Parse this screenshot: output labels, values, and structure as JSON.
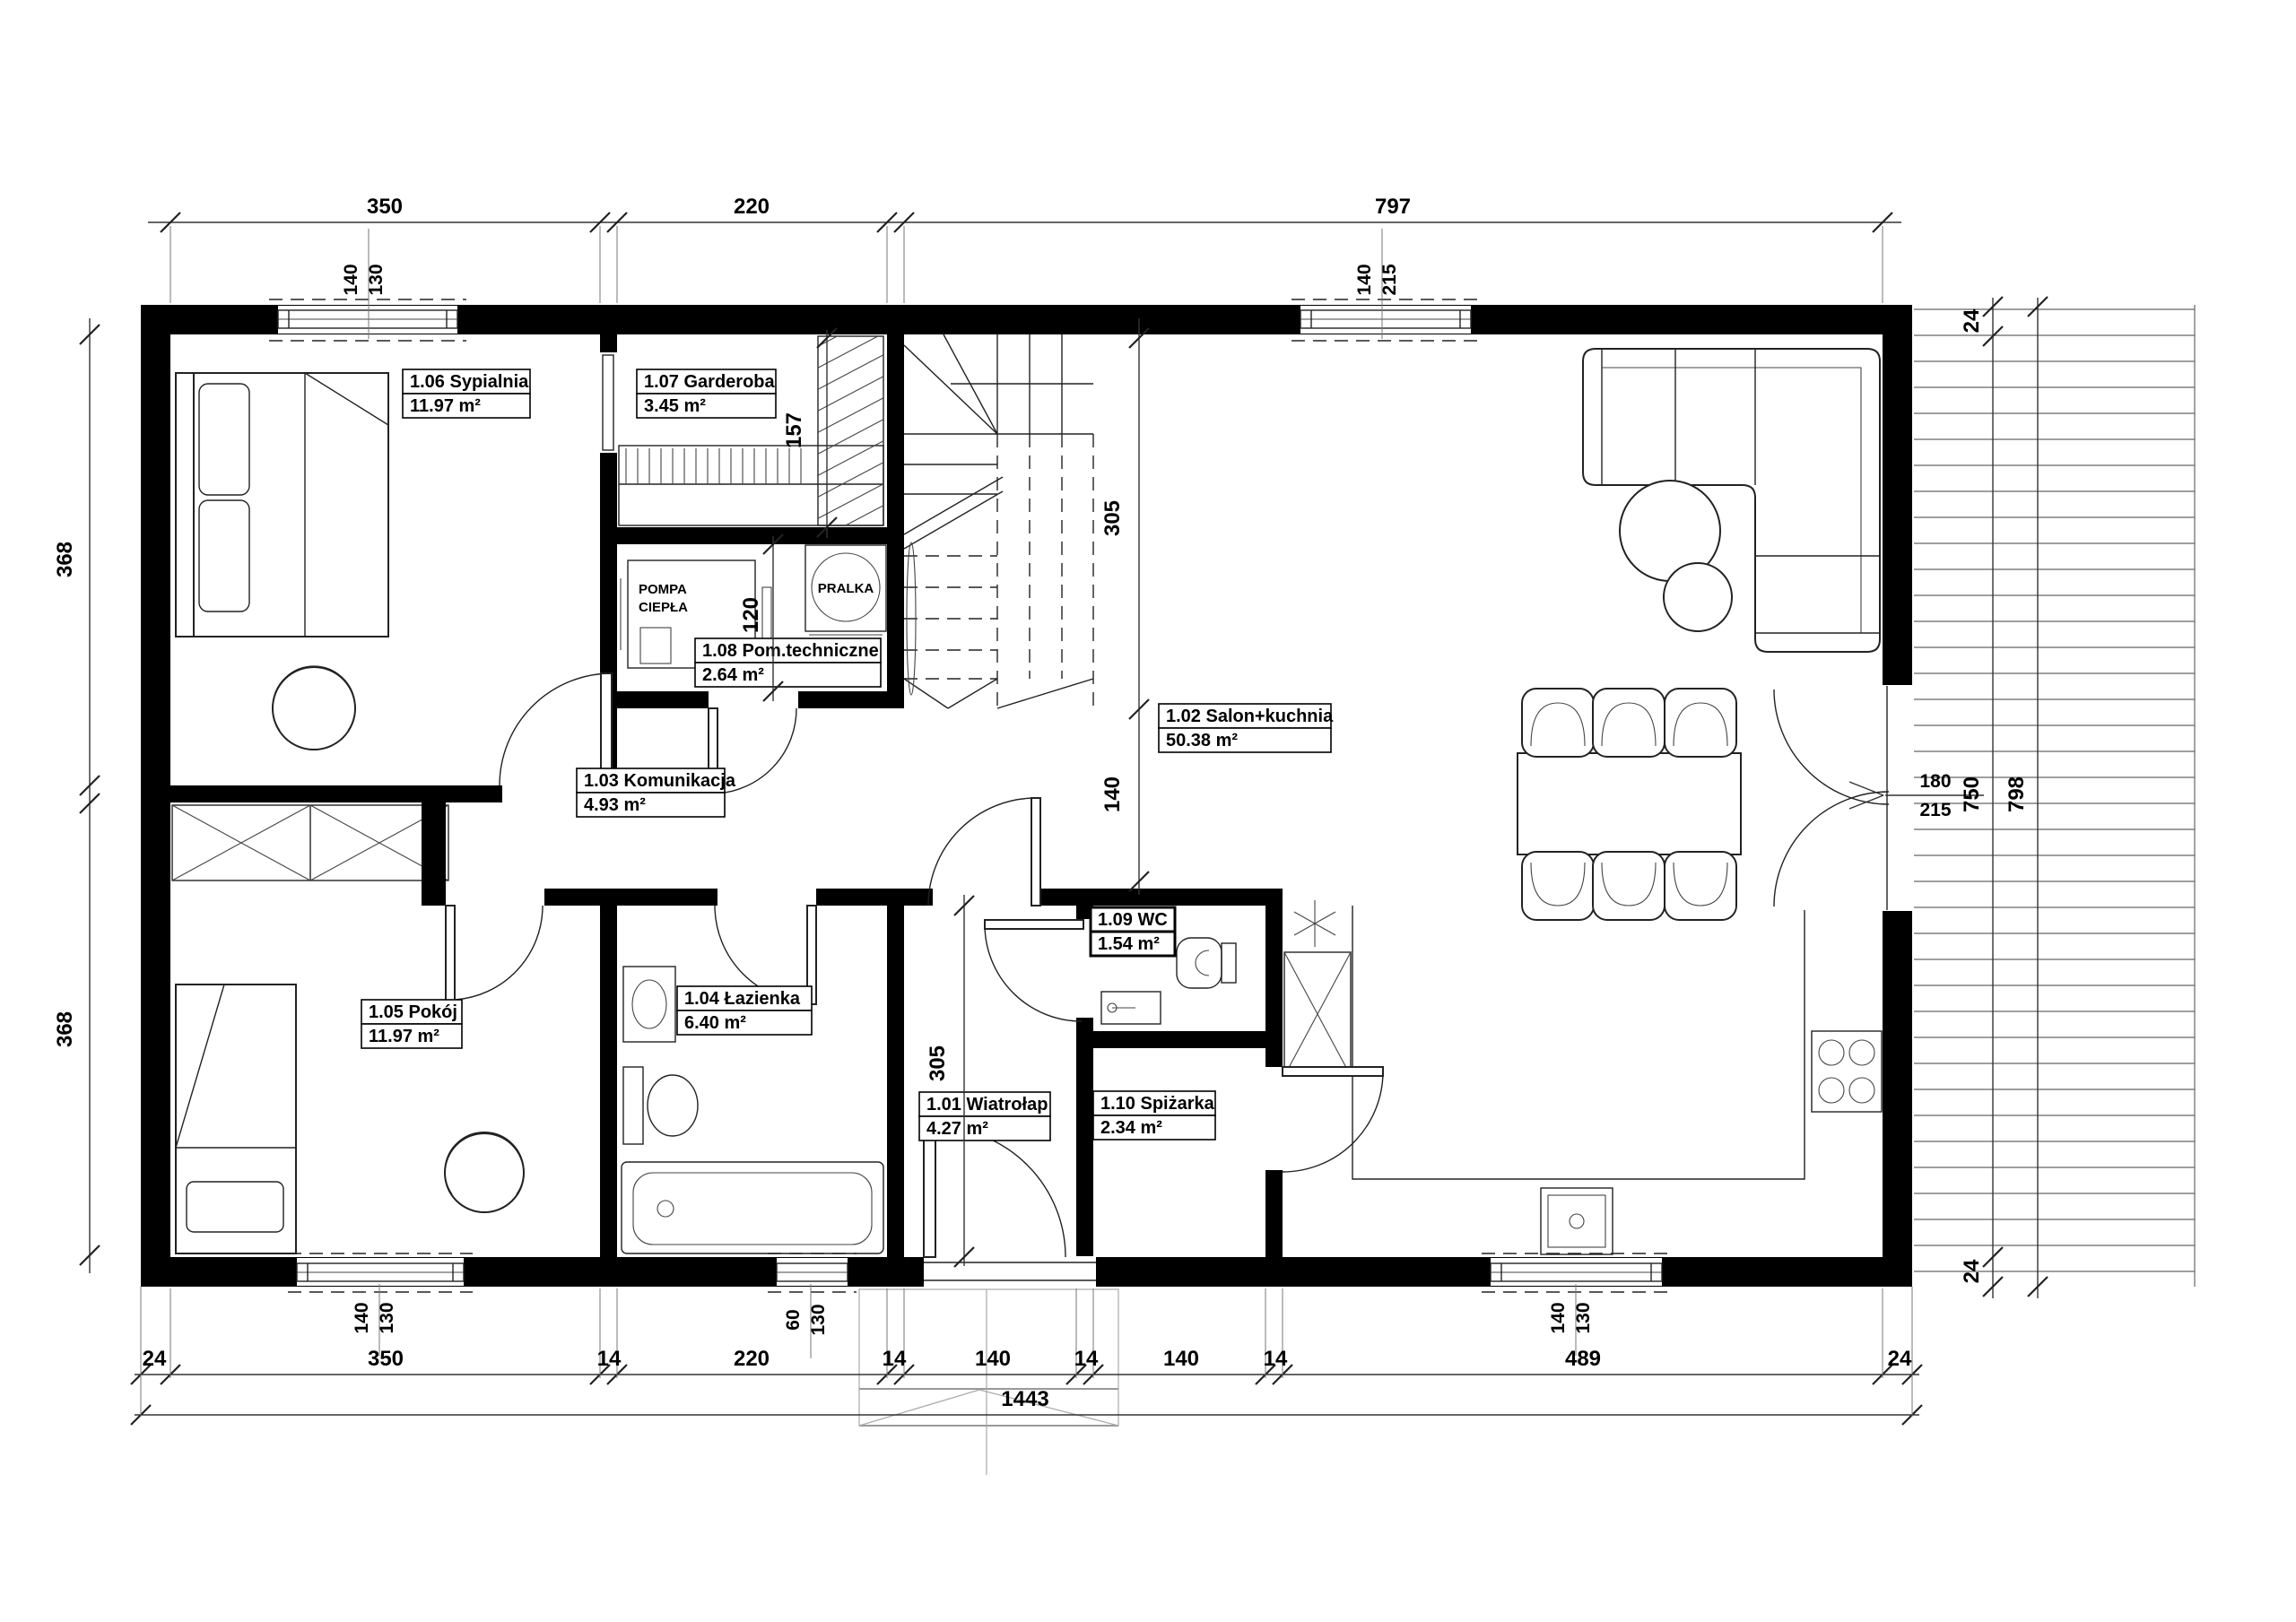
{
  "rooms": [
    {
      "name": "1.01 Wiatrołap",
      "area": "4.27 m²"
    },
    {
      "name": "1.02 Salon+kuchnia",
      "area": "50.38 m²"
    },
    {
      "name": "1.03 Komunikacja",
      "area": "4.93 m²"
    },
    {
      "name": "1.04 Łazienka",
      "area": "6.40 m²"
    },
    {
      "name": "1.05 Pokój",
      "area": "11.97 m²"
    },
    {
      "name": "1.06 Sypialnia",
      "area": "11.97 m²"
    },
    {
      "name": "1.07 Garderoba",
      "area": "3.45 m²"
    },
    {
      "name": "1.08 Pom.techniczne",
      "area": "2.64 m²"
    },
    {
      "name": "1.09 WC",
      "area": "1.54 m²"
    },
    {
      "name": "1.10 Spiżarka",
      "area": "2.34 m²"
    }
  ],
  "equipment": {
    "heat_pump_line1": "POMPA",
    "heat_pump_line2": "CIEPŁA",
    "washer": "PRALKA"
  },
  "dims": {
    "top": [
      "350",
      "220",
      "797"
    ],
    "bottom": [
      "24",
      "350",
      "14",
      "220",
      "14",
      "140",
      "14",
      "140",
      "14",
      "489",
      "24"
    ],
    "total": "1443",
    "left": [
      "368",
      "368"
    ],
    "right_wall_top": "24",
    "right_inner": "750",
    "right_outer": "798",
    "right_wall_bottom": "24",
    "door_right": [
      "180",
      "215"
    ],
    "garderoba_depth": "157",
    "pomtech_depth": "120",
    "salon_upper": "305",
    "salon_opening": "140",
    "wiatrolap_depth": "305",
    "win_top_left": [
      "140",
      "130"
    ],
    "win_top_right": [
      "140",
      "215"
    ],
    "win_bottom_left": [
      "140",
      "130"
    ],
    "win_bottom_mid": [
      "60",
      "130"
    ],
    "win_bottom_right": [
      "140",
      "130"
    ]
  }
}
